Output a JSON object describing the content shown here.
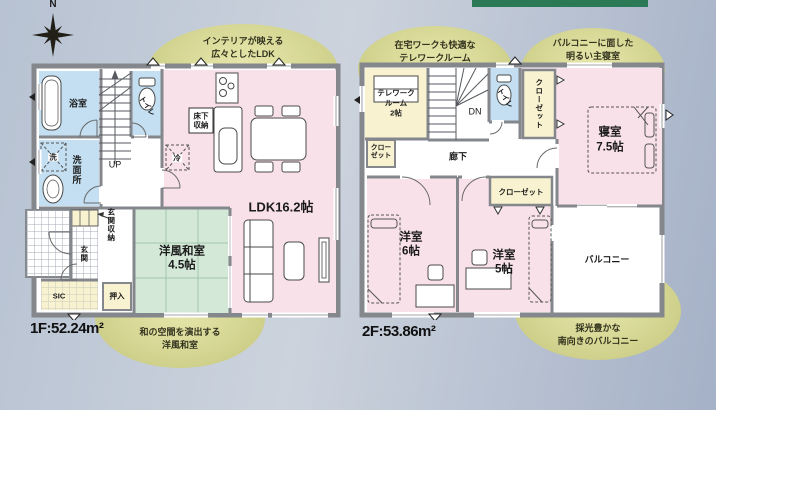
{
  "page": {
    "bg_left": "#b7c2d2",
    "bg_mid": "#ccd3dd",
    "bg_right": "#a5b1c7",
    "accent_bar": "#2c7a55",
    "callout_fill": "#c9cb80",
    "wall": "#84878c",
    "room_pink": "#f9e1e9",
    "room_blue": "#c3dff1",
    "room_cream": "#f8f2d0",
    "room_green": "#d4e8d8"
  },
  "compass": {
    "label": "N"
  },
  "floor1": {
    "area": "1F:52.24m²",
    "callout_top": [
      "インテリアが映える",
      "広々としたLDK"
    ],
    "callout_bottom": [
      "和の空間を演出する",
      "洋風和室"
    ],
    "labels": {
      "bath": "浴室",
      "washroom": "洗面所",
      "washer": "洗",
      "toilet": "トイレ",
      "up": "UP",
      "floor_storage_1": "床下",
      "floor_storage_2": "収納",
      "fridge": "冷",
      "ldk": "LDK16.2帖",
      "entrance_storage": "玄関収納",
      "entrance": "玄関",
      "sic": "SIC",
      "oshiire": "押入",
      "washitsu_1": "洋風和室",
      "washitsu_2": "4.5帖"
    }
  },
  "floor2": {
    "area": "2F:53.86m²",
    "callout_top_left": [
      "在宅ワークも快適な",
      "テレワークルーム"
    ],
    "callout_top_right": [
      "バルコニーに面した",
      "明るい主寝室"
    ],
    "callout_bottom": [
      "採光豊かな",
      "南向きのバルコニー"
    ],
    "labels": {
      "telework_1": "テレワーク",
      "telework_2": "ルーム",
      "telework_3": "2帖",
      "dn": "DN",
      "toilet": "トイレ",
      "closet_tall": "クローゼット",
      "closet_small_1": "クロー",
      "closet_small_2": "ゼット",
      "hallway": "廊下",
      "bedroom_1": "寝室",
      "bedroom_2": "7.5帖",
      "closet_w5": "クローゼット",
      "west6_1": "洋室",
      "west6_2": "6帖",
      "west5_1": "洋室",
      "west5_2": "5帖",
      "balcony": "バルコニー"
    }
  }
}
